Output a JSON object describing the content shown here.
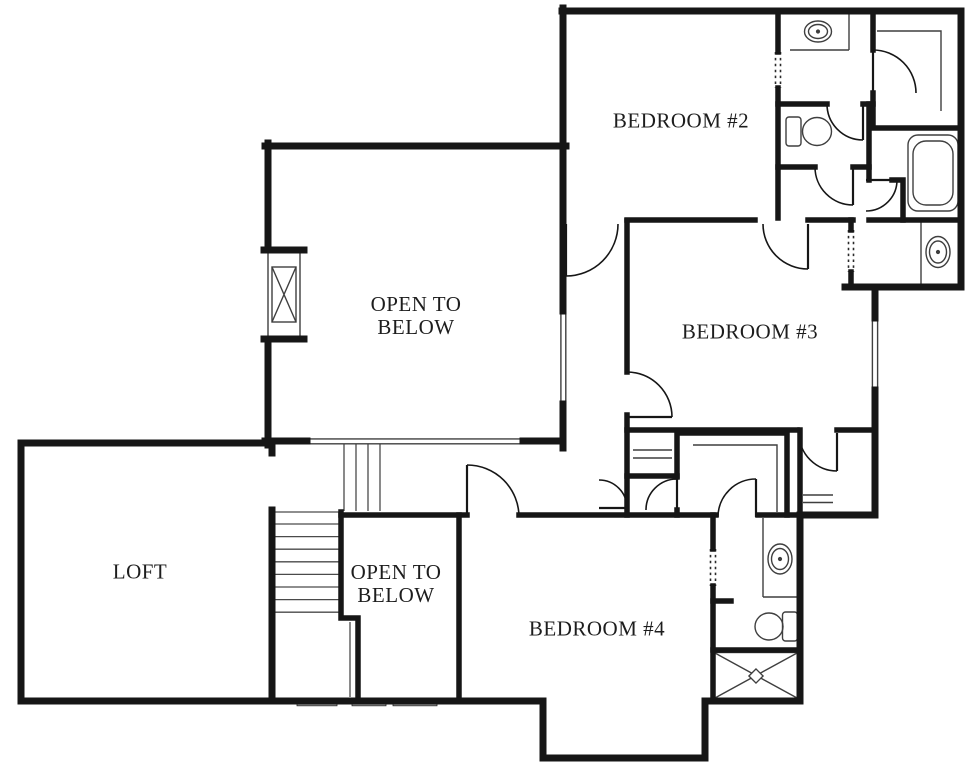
{
  "plan": {
    "rooms": {
      "bedroom2": {
        "label": "BEDROOM #2"
      },
      "bedroom3": {
        "label": "BEDROOM #3"
      },
      "bedroom4": {
        "label": "BEDROOM #4"
      },
      "open_below_upper": {
        "line1": "OPEN TO",
        "line2": "BELOW"
      },
      "open_below_lower": {
        "line1": "OPEN TO",
        "line2": "BELOW"
      },
      "loft": {
        "label": "LOFT"
      }
    },
    "colors": {
      "wall": "#161616",
      "thin_line": "#3f3f3f",
      "window_fill": "#a8a8a8",
      "background": "#ffffff",
      "text": "#1d1d1d"
    },
    "fixture_names": [
      "sink",
      "toilet",
      "bathtub",
      "shower",
      "fireplace-chimney",
      "stairs",
      "closet-shelves",
      "door-swing",
      "window",
      "railing"
    ]
  }
}
